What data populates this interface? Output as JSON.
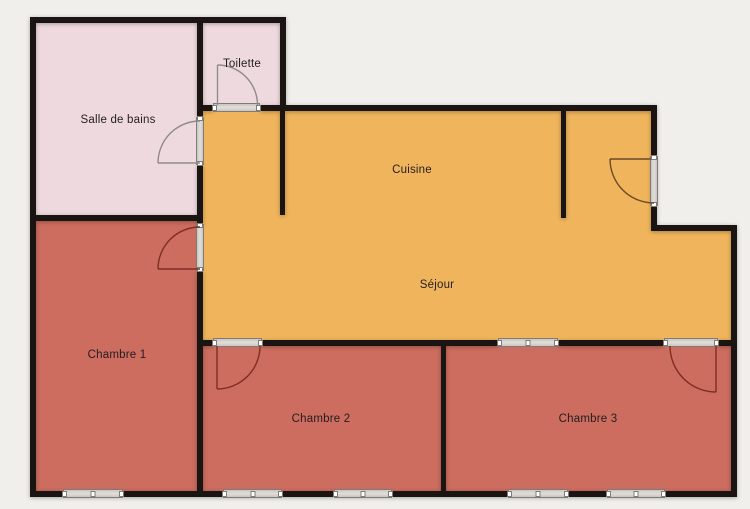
{
  "plan": {
    "type": "apartment-floor-plan"
  },
  "rooms": {
    "salle_de_bains": {
      "label": "Salle de bains",
      "color": "#eedade"
    },
    "toilette": {
      "label": "Toilette",
      "color": "#eedade"
    },
    "cuisine": {
      "label": "Cuisine",
      "color": "#f0b55c"
    },
    "sejour": {
      "label": "Séjour",
      "color": "#f0b55c"
    },
    "chambre_1": {
      "label": "Chambre 1",
      "color": "#cc6d5f"
    },
    "chambre_2": {
      "label": "Chambre 2",
      "color": "#cc6d5f"
    },
    "chambre_3": {
      "label": "Chambre 3",
      "color": "#cc6d5f"
    }
  },
  "palette": {
    "background": "#f0efec",
    "wall": "#1a1512",
    "opening_fill": "#d4d1cc",
    "opening_border": "#807b76",
    "door_arc_gray": "#8f8a8d",
    "door_arc_red": "#7d2f22",
    "door_arc_brown": "#6b4a26",
    "label_color": "#231d20"
  }
}
